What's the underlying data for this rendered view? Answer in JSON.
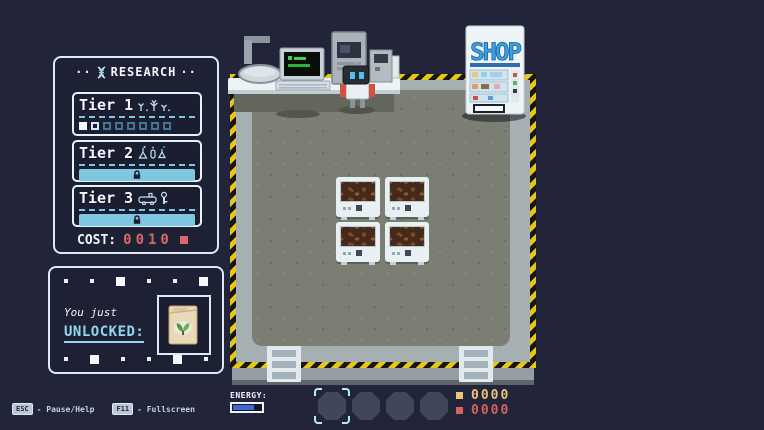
{
  "colors": {
    "background": "#22243a",
    "panel_border": "#dcebf3",
    "accent_blue": "#7fc6e0",
    "white": "#f2f7fa",
    "cost_red": "#d96868",
    "counter_orange": "#eec17c",
    "counter_red": "#d96060",
    "hazard_yellow": "#e6c51d",
    "floor_gray": "#7b7e73",
    "band_gray": "#a6b0b3",
    "energy_blue": "#3f66d4",
    "shop_blue": "#38a2e0"
  },
  "research_panel": {
    "decor_left": "··",
    "decor_right": "··",
    "title": "RESEARCH",
    "tiers": [
      {
        "label": "Tier 1",
        "icon": "plants",
        "state": "active",
        "progress": {
          "total": 8,
          "done": 1,
          "current_index": 1
        }
      },
      {
        "label": "Tier 2",
        "icon": "chemistry",
        "state": "locked"
      },
      {
        "label": "Tier 3",
        "icon": "machines",
        "state": "locked"
      }
    ],
    "cost_label": "COST:",
    "cost_value": "0010"
  },
  "unlocked_panel": {
    "line1": "You just",
    "line2": "UNLOCKED:",
    "item": "seed-packet",
    "deco_top": [
      "s",
      "s",
      "l",
      "s",
      "s",
      "l"
    ],
    "deco_bottom": [
      "s",
      "l",
      "s",
      "s",
      "l",
      "s"
    ]
  },
  "shop": {
    "sign_text": "SHOP"
  },
  "field": {
    "planters": [
      {
        "row": 0,
        "col": 0
      },
      {
        "row": 0,
        "col": 1
      },
      {
        "row": 1,
        "col": 0
      },
      {
        "row": 1,
        "col": 1
      }
    ]
  },
  "hud": {
    "energy_label": "ENERGY:",
    "energy_fill_pct": 75,
    "slots_total": 4,
    "selected_slot": 0,
    "counters": [
      {
        "color": "#eec17c",
        "value": "0000"
      },
      {
        "color": "#d96060",
        "value": "0000"
      }
    ]
  },
  "hotkeys": [
    {
      "key": "ESC",
      "action": "- Pause/Help"
    },
    {
      "key": "F11",
      "action": "- Fullscreen"
    }
  ]
}
